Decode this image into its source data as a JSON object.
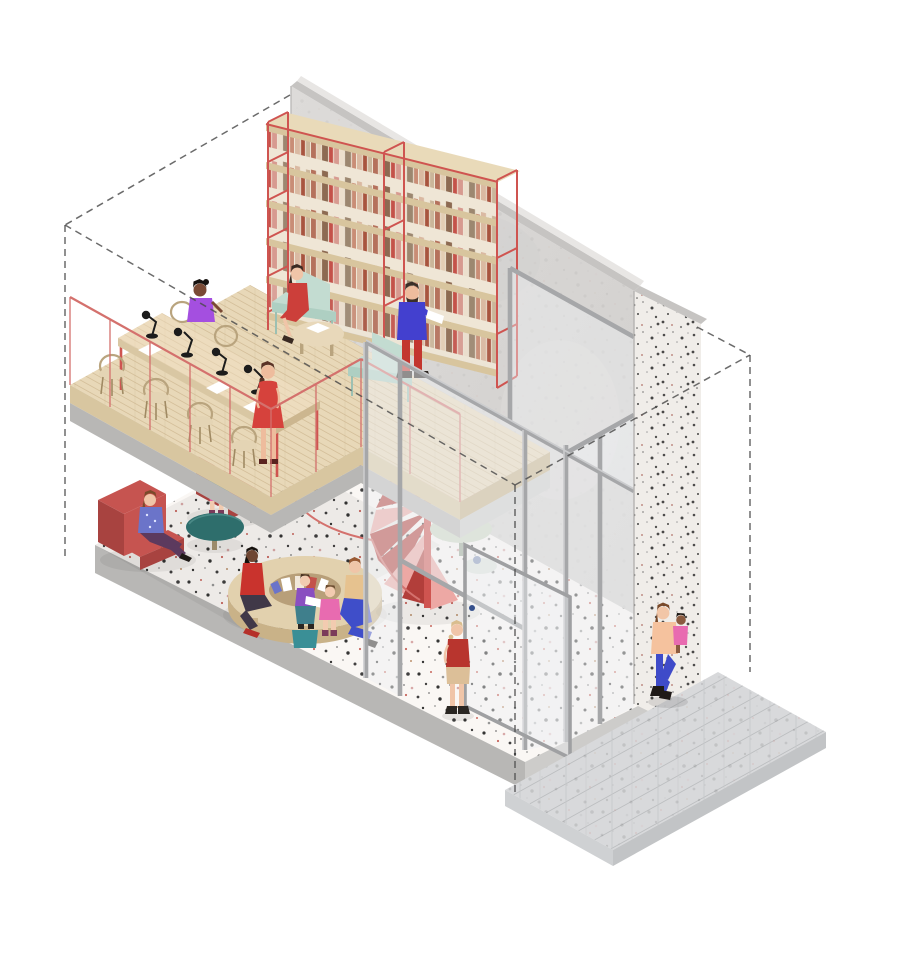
{
  "meta": {
    "title": "Axonometric cutaway illustration of a two-storey community library",
    "artwork_type": "architectural axonometric cutaway drawing",
    "canvas": {
      "width": 900,
      "height": 960
    },
    "background": "#ffffff",
    "text_content": "none — image contains no rendered text"
  },
  "colors": {
    "accent-red": "#cf5450",
    "railing-red": "#d4716d",
    "stair-red-dark": "#b23e3a",
    "stair-pink": "#eda8a4",
    "wood-light": "#e8d8b8",
    "wood-mid": "#d8c6a0",
    "wood-dark": "#c6b189",
    "wall-concrete": "#d8d6d4",
    "wall-cap": "#c6c4c2",
    "wall-cap-light": "#e8e6e4",
    "pier-base": "#f0ede9",
    "terrazzo-base": "#faf7f4",
    "slab-gray": "#b8b7b5",
    "slab-gray-light": "#cdccca",
    "glass-tint": "#eef0f2",
    "mullion-gray": "#a6a7a9",
    "mullion-light": "#cbccce",
    "sidewalk-gray": "#d8d9db",
    "paver-joint": "#c1c3c5",
    "mint": "#c3dcd1",
    "mint-dark": "#9cc0b2",
    "sofa-red": "#c65450",
    "sofa-red-dark": "#a84340",
    "teal-table": "#2e6e6c",
    "sage-table": "#ccd8c5",
    "ink": "#4a4a4a"
  },
  "scene": {
    "outline": {
      "label": "dashed wireframe of the building volume",
      "style": "black dashed lines forming an isometric box"
    },
    "architecture": [
      {
        "id": "back-wall",
        "label": "concrete back wall, cut at top",
        "material": "smooth light concrete"
      },
      {
        "id": "corner-pier",
        "label": "cut section of side wall at the glazed corner",
        "material": "speckled terrazzo concrete"
      },
      {
        "id": "glazed-facade",
        "label": "double-height glazed facade with grey mullions, transom and open glass door"
      },
      {
        "id": "mezzanine",
        "label": "timber mezzanine floor with red steel guardrail and concrete slab edge"
      },
      {
        "id": "ground-slab",
        "label": "terrazzo ground-floor slab with multicolour speckle"
      },
      {
        "id": "spiral-stair",
        "label": "red spiral staircase connecting the two floors"
      },
      {
        "id": "sidewalk",
        "label": "grey stone-paved sidewalk outside the glazing"
      }
    ],
    "upper_floor_furniture": [
      {
        "id": "wall-bookshelf",
        "label": "wall-length bookshelf, red steel frame with timber shelves",
        "bays": 2,
        "book_rows": 5
      },
      {
        "id": "reading-table",
        "label": "long timber reading table on red steel legs",
        "items": [
          "4 black task lamps",
          "papers and open books"
        ]
      },
      {
        "id": "wooden-chairs",
        "label": "hoop-back timber chairs",
        "count": 6
      },
      {
        "id": "lounge-chairs",
        "label": "mint-green lounge armchairs",
        "count": 2
      },
      {
        "id": "coffee-table",
        "label": "round timber coffee table with open book"
      }
    ],
    "ground_floor_furniture": [
      {
        "id": "red-armchairs",
        "label": "red upholstered armchairs",
        "count": 2
      },
      {
        "id": "side-table",
        "label": "round teal side table"
      },
      {
        "id": "book-ring",
        "label": "circular timber book-display table with picture books in its well"
      },
      {
        "id": "kids-stool",
        "label": "small teal children's stool"
      },
      {
        "id": "cafe-table",
        "label": "round pale-green table behind the glazing"
      },
      {
        "id": "low-stool",
        "label": "small pale stool behind the glazing"
      }
    ],
    "people": [
      {
        "id": "seated-reader-table",
        "label": "woman seated at the long reading table",
        "floor": "mezzanine",
        "colors": {
          "top": "#a44fe0",
          "skin": "#7a4a35",
          "hair": "#171310"
        }
      },
      {
        "id": "standing-woman-red-dress",
        "label": "woman in red dress standing at the table end, hands behind back",
        "floor": "mezzanine",
        "colors": {
          "dress": "#d6423c",
          "skin": "#eebc9d",
          "hair": "#5a3326"
        }
      },
      {
        "id": "woman-lounge-chair",
        "label": "woman in red dress seated in mint lounge chair",
        "floor": "mezzanine",
        "colors": {
          "dress": "#cc3f3a",
          "skin": "#f0c5a8",
          "hair": "#3a2a22"
        }
      },
      {
        "id": "man-reading-standing",
        "label": "bearded man standing by the bookshelf reading",
        "floor": "mezzanine",
        "colors": {
          "sweater": "#4340cf",
          "trousers": "#c3362f",
          "skin": "#eebc9d",
          "hair": "#3a2f28",
          "book": "#ffffff"
        }
      },
      {
        "id": "child-red-armchair",
        "label": "child perched on red armchair",
        "floor": "ground",
        "colors": {
          "shirt": "#2f8c80",
          "shorts": "#e35fa5",
          "skin": "#f2cbb0",
          "hair": "#6b4a2f"
        }
      },
      {
        "id": "woman-armchair-ground",
        "label": "woman reading in red armchair under the mezzanine",
        "floor": "ground",
        "colors": {
          "top": "#6b74c9",
          "trousers": "#5c3a5e",
          "skin": "#f0c5a8",
          "hair": "#7a4a2a"
        }
      },
      {
        "id": "woman-red-jacket",
        "label": "woman in red jacket seated at the circular book table",
        "floor": "ground",
        "colors": {
          "jacket": "#c9332d",
          "trousers": "#403848",
          "skin": "#6e4632",
          "hair": "#15100c",
          "shoes": "#b5302a"
        }
      },
      {
        "id": "child-reading",
        "label": "child reading a picture book on the teal stool",
        "floor": "ground",
        "colors": {
          "top": "#8a4fc0",
          "trousers": "#3f7f8c",
          "skin": "#f2cbb0",
          "book": "#ffffff"
        }
      },
      {
        "id": "child-pink",
        "label": "child in pink sitting at the book table",
        "floor": "ground",
        "colors": {
          "dress": "#e86bb0",
          "skin": "#f2cbb0",
          "hair": "#6b4a2f",
          "boots": "#7a3a5a"
        }
      },
      {
        "id": "woman-blue-trousers",
        "label": "woman in wide blue trousers on the book-table edge",
        "floor": "ground",
        "colors": {
          "top": "#e6c28f",
          "trousers": "#3f4ec9",
          "skin": "#f0c5a8",
          "hair": "#9a5a33"
        }
      },
      {
        "id": "visitor-at-door",
        "label": "person standing inside by the open glass door",
        "floor": "ground",
        "colors": {
          "shirt": "#b8352e",
          "shorts": "#dcbf98",
          "skin": "#f0c5a8",
          "hair": "#d9bd8e",
          "boots": "#2a2622"
        }
      },
      {
        "id": "woman-outside",
        "label": "woman walking on the sidewalk carrying a toddler",
        "floor": "exterior",
        "colors": {
          "top": "#f5c29e",
          "jeans": "#3f4bc9",
          "skin": "#f2c6a7",
          "hair": "#7a4a2a",
          "boots": "#1f1a17"
        }
      },
      {
        "id": "toddler-carried",
        "label": "toddler carried on the woman's arm",
        "floor": "exterior",
        "colors": {
          "outfit": "#e86bb0",
          "skin": "#8a5a3f",
          "hair": "#171310"
        }
      }
    ]
  }
}
